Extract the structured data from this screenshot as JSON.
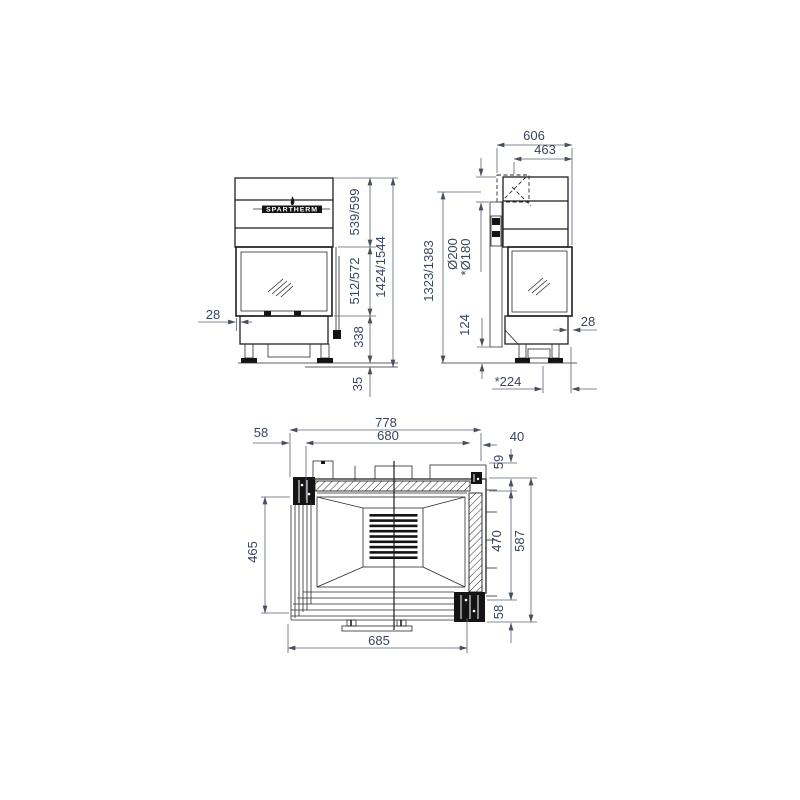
{
  "brand": "SPARTHERM",
  "front_view": {
    "overhang": "28",
    "hood_height": "539/599",
    "glass_height": "512/572",
    "base_height": "338",
    "foot_height": "35",
    "total_height": "1424/1544"
  },
  "side_view": {
    "depth": "606",
    "flue_center": "463",
    "flue_diameter": "Ø200",
    "flue_diameter_alt": "*Ø180",
    "flue_height": "1323/1383",
    "plinth_height": "124",
    "overhang": "28",
    "foot_depth": "*224"
  },
  "plan_view": {
    "overall_width": "778",
    "inner_width": "680",
    "left_offset": "58",
    "right_offset": "40",
    "rear_offset": "59",
    "inner_depth": "470",
    "overall_depth": "587",
    "front_offset": "58",
    "side_glass_depth": "465",
    "front_glass_width": "685"
  }
}
